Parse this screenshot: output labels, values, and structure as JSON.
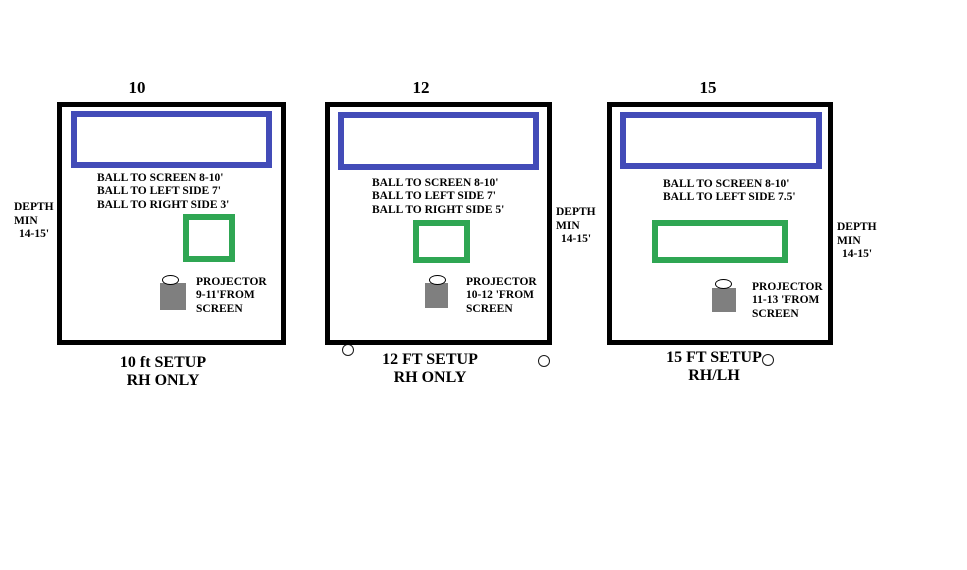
{
  "colors": {
    "room_border": "#000000",
    "screen_border": "#434cb8",
    "hitting_area_border": "#2fa653",
    "projector_fill": "#7f7f7f",
    "text": "#000000",
    "background": "#ffffff"
  },
  "diagrams": [
    {
      "title": "10",
      "ball_lines": [
        "BALL TO SCREEN 8-10'",
        "BALL TO LEFT SIDE 7'",
        "BALL TO RIGHT SIDE 3'"
      ],
      "projector_lines": [
        "PROJECTOR",
        "9-11'FROM",
        "SCREEN"
      ],
      "caption_lines": [
        "10 ft SETUP",
        "RH ONLY"
      ],
      "depth_lines": [
        "DEPTH",
        "MIN",
        "14-15'"
      ]
    },
    {
      "title": "12",
      "ball_lines": [
        "BALL TO SCREEN 8-10'",
        "BALL TO LEFT SIDE 7'",
        "BALL TO RIGHT SIDE 5'"
      ],
      "projector_lines": [
        "PROJECTOR",
        "10-12 'FROM",
        "SCREEN"
      ],
      "caption_lines": [
        "12 FT SETUP",
        "RH ONLY"
      ],
      "depth_lines": [
        "DEPTH",
        "MIN",
        "14-15'"
      ]
    },
    {
      "title": "15",
      "ball_lines": [
        "BALL TO SCREEN 8-10'",
        "BALL TO LEFT SIDE 7.5'"
      ],
      "projector_lines": [
        "PROJECTOR",
        "11-13 'FROM",
        "SCREEN"
      ],
      "caption_lines": [
        "15 FT SETUP",
        "RH/LH"
      ],
      "depth_lines": [
        "DEPTH",
        "MIN",
        "14-15'"
      ]
    }
  ]
}
